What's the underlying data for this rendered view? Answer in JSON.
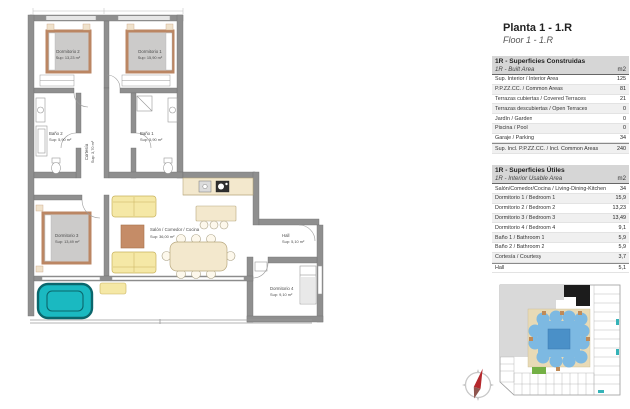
{
  "header": {
    "title": "Planta 1 - 1.R",
    "subtitle": "Floor 1 - 1.R"
  },
  "tables": [
    {
      "title_es": "1R - Superficies Construidas",
      "title_en": "1R - Built Area",
      "unit": "m2",
      "rows": [
        {
          "label": "Sup. Interior / Interior Area",
          "value": "125"
        },
        {
          "label": "P.P.ZZ.CC. / Common Areas",
          "value": "81"
        },
        {
          "label": "Terrazas cubiertas / Covered Terraces",
          "value": "21"
        },
        {
          "label": "Terrazas descubiertas / Open Terraces",
          "value": "0"
        },
        {
          "label": "Jardín / Garden",
          "value": "0"
        },
        {
          "label": "Piscina / Pool",
          "value": "0"
        },
        {
          "label": "Garaje / Parking",
          "value": "34"
        },
        {
          "label": "Sup. Incl. P.P.ZZ.CC. / Incl. Common Areas",
          "value": "240"
        }
      ]
    },
    {
      "title_es": "1R - Superficies Útiles",
      "title_en": "1R - Interior Usable Area",
      "unit": "m2",
      "rows": [
        {
          "label": "Salón/Comedor/Cocina / Living-Dining-Kitchen",
          "value": "34"
        },
        {
          "label": "Dormitorio 1 / Bedroom 1",
          "value": "15,9"
        },
        {
          "label": "Dormitorio 2 / Bedroom 2",
          "value": "13,23"
        },
        {
          "label": "Dormitorio 3 / Bedroom 3",
          "value": "13,49"
        },
        {
          "label": "Dormitorio 4 / Bedroom 4",
          "value": "9,1"
        },
        {
          "label": "Baño 1 / Bathroom 1",
          "value": "5,9"
        },
        {
          "label": "Baño 2 / Bathroom 2",
          "value": "5,9"
        },
        {
          "label": "Cortesía / Courtesy",
          "value": "3,7"
        },
        {
          "label": "Hall",
          "value": "5,1"
        }
      ]
    }
  ],
  "plan": {
    "rooms": {
      "dormitorio2": {
        "name": "Dormitorio 2",
        "area": "Sup: 13,23 m²"
      },
      "dormitorio1": {
        "name": "Dormitorio 1",
        "area": "Sup: 15,90 m²"
      },
      "bano2": {
        "name": "Baño 2",
        "area": "Sup: 5,90 m²"
      },
      "bano1": {
        "name": "Baño 1",
        "area": "Sup: 5,90 m²"
      },
      "cortesia": {
        "name": "Cortesía",
        "area": "Sup: 3,70 m²"
      },
      "dormitorio3": {
        "name": "Dormitorio 3",
        "area": "Sup: 13,49 m²"
      },
      "salon": {
        "name": "Salón / Comedor / Cocina",
        "area": "Sup: 36,00 m²"
      },
      "hall": {
        "name": "Hall",
        "area": "Sup: 5,10 m²"
      },
      "dormitorio4": {
        "name": "Dormitorio 4",
        "area": "Sup: 9,10 m²"
      }
    }
  },
  "icons": {
    "compass": "compass-north-icon",
    "minimap": "site-plan-minimap"
  },
  "colors": {
    "wall_gray": "#8f8f8f",
    "table_header_gray": "#d6d6d6",
    "bed_frame_tan": "#bb8663",
    "sofa_yellow": "#f5e8a6",
    "kitchen_beige": "#f3e8cd",
    "rug_brown": "#c58c67",
    "jacuzzi_teal": "#1ab9c1",
    "minimap_pool_blue": "#4a90c8",
    "minimap_courtyard_beige": "#e8dab6",
    "minimap_highlight_black": "#1c1c1c",
    "minimap_green": "#74b045",
    "compass_red": "#b5282c"
  }
}
